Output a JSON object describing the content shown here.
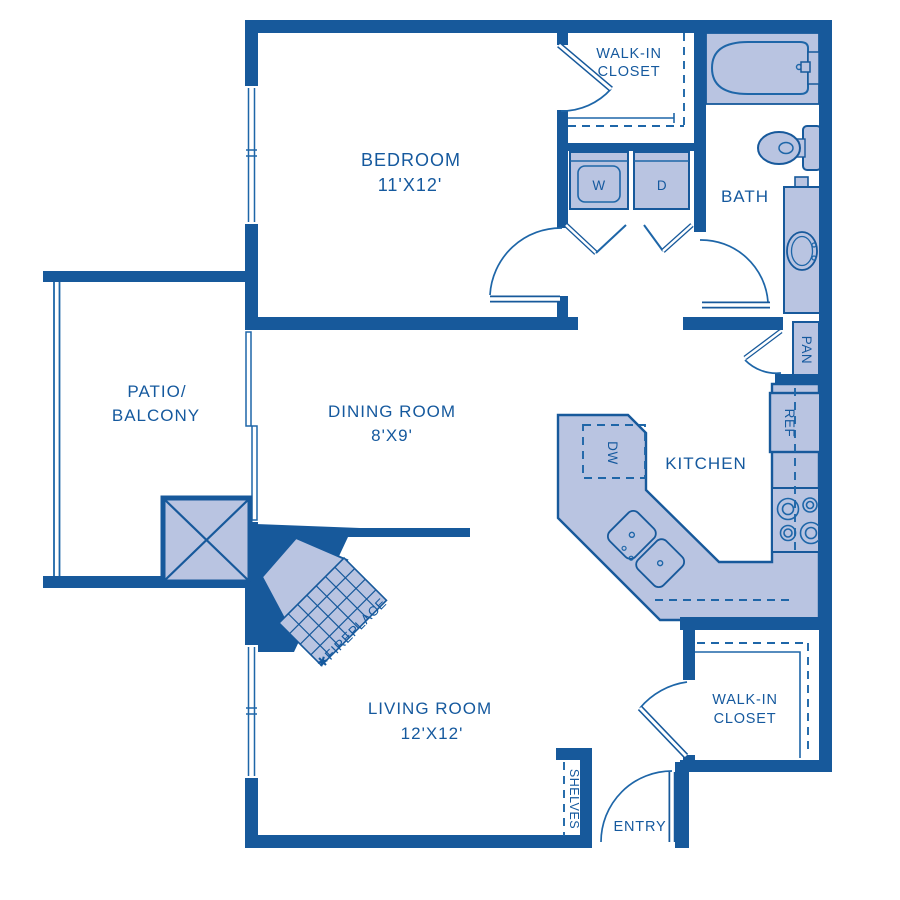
{
  "rooms": {
    "bedroom": {
      "name": "BEDROOM",
      "dims": "11'X12'"
    },
    "dining": {
      "name": "DINING ROOM",
      "dims": "8'X9'"
    },
    "living": {
      "name": "LIVING ROOM",
      "dims": "12'X12'"
    },
    "kitchen": {
      "name": "KITCHEN"
    },
    "bath": {
      "name": "BATH"
    },
    "patio": {
      "line1": "PATIO/",
      "line2": "BALCONY"
    },
    "closet_top": {
      "line1": "WALK-IN",
      "line2": "CLOSET"
    },
    "closet_bottom": {
      "line1": "WALK-IN",
      "line2": "CLOSET"
    },
    "entry": {
      "name": "ENTRY"
    }
  },
  "fixtures": {
    "washer": "W",
    "dryer": "D",
    "dishwasher": "DW",
    "refrigerator": "REF",
    "pantry": "PAN",
    "shelves": "SHELVES",
    "fireplace": "✱FIREPLACE"
  },
  "colors": {
    "wall": "#17599b",
    "fixture_fill": "#b9c4e1",
    "line": "#1e66a8",
    "text": "#15599e",
    "background": "#ffffff"
  }
}
